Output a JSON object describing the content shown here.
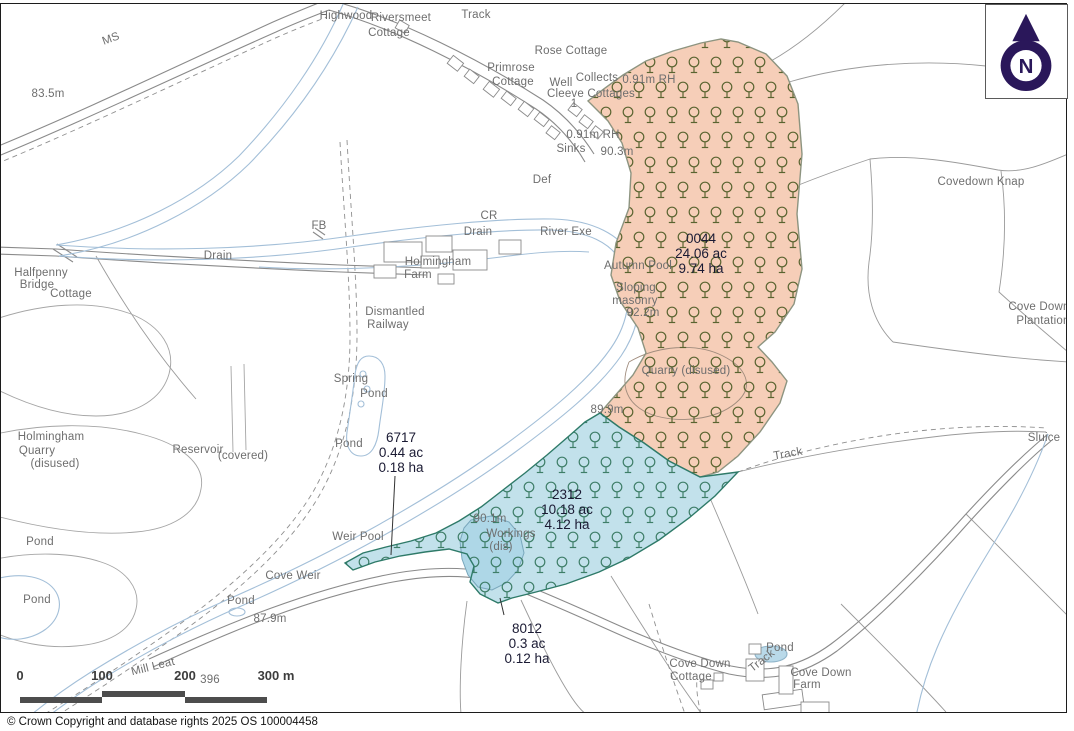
{
  "footer": {
    "copyright": "© Crown Copyright and database rights 2025 OS 100004458"
  },
  "north_arrow": {
    "label": "N"
  },
  "scale_bar": {
    "labels": [
      "0",
      "100",
      "200",
      "300 m"
    ]
  },
  "colors": {
    "parcel_orange_fill": "#f6ceb8",
    "parcel_orange_tree": "#5a6430",
    "parcel_orange_border": "#8d9480",
    "parcel_blue_fill": "#c2e1eb",
    "parcel_blue_tree": "#3e7e68",
    "parcel_blue_border": "#2e7a68",
    "parcel_label_text": "#1a1a33",
    "map_line": "#8f8f8f",
    "water_line": "#a3bfd8",
    "map_label_text": "#6e6e6e",
    "north_arrow_navy": "#2a175a",
    "scale_bar_gray": "#4d4d4d"
  },
  "map": {
    "parcels": [
      {
        "id": "0044",
        "acres": "24.06 ac",
        "hectares": "9.74 ha",
        "x": 700,
        "y": 227
      },
      {
        "id": "2312",
        "acres": "10.18 ac",
        "hectares": "4.12 ha",
        "x": 566,
        "y": 483
      },
      {
        "id": "6717",
        "acres": "0.44 ac",
        "hectares": "0.18 ha",
        "x": 400,
        "y": 426
      },
      {
        "id": "8012",
        "acres": "0.3 ac",
        "hectares": "0.12 ha",
        "x": 526,
        "y": 617
      }
    ],
    "labels": [
      {
        "text": "MS",
        "x": 110,
        "y": 35,
        "r": -20
      },
      {
        "text": "83.5m",
        "x": 47,
        "y": 90
      },
      {
        "text": "Highwood",
        "x": 345,
        "y": 12
      },
      {
        "text": "Riversmeet",
        "x": 400,
        "y": 14
      },
      {
        "text": "Cottage",
        "x": 388,
        "y": 29
      },
      {
        "text": "Track",
        "x": 475,
        "y": 11
      },
      {
        "text": "Rose Cottage",
        "x": 570,
        "y": 47
      },
      {
        "text": "Primrose",
        "x": 510,
        "y": 64
      },
      {
        "text": "Cottage",
        "x": 512,
        "y": 78
      },
      {
        "text": "Well",
        "x": 560,
        "y": 79
      },
      {
        "text": "Collects",
        "x": 596,
        "y": 74
      },
      {
        "text": "0.91m RH",
        "x": 648,
        "y": 76
      },
      {
        "text": "Cleeve Cottages",
        "x": 590,
        "y": 90
      },
      {
        "text": "1",
        "x": 573,
        "y": 100
      },
      {
        "text": "0.91m RH",
        "x": 592,
        "y": 131
      },
      {
        "text": "Sinks",
        "x": 570,
        "y": 145
      },
      {
        "text": "90.3m",
        "x": 616,
        "y": 148
      },
      {
        "text": "Def",
        "x": 541,
        "y": 176
      },
      {
        "text": "FB",
        "x": 318,
        "y": 222
      },
      {
        "text": "CR",
        "x": 488,
        "y": 212
      },
      {
        "text": "Drain",
        "x": 477,
        "y": 228
      },
      {
        "text": "River Exe",
        "x": 565,
        "y": 228
      },
      {
        "text": "Drain",
        "x": 217,
        "y": 252
      },
      {
        "text": "Halfpenny",
        "x": 40,
        "y": 269
      },
      {
        "text": "Bridge",
        "x": 36,
        "y": 281
      },
      {
        "text": "Cottage",
        "x": 70,
        "y": 290
      },
      {
        "text": "Holmingham",
        "x": 437,
        "y": 258
      },
      {
        "text": "Farm",
        "x": 417,
        "y": 271
      },
      {
        "text": "Dismantled",
        "x": 394,
        "y": 308
      },
      {
        "text": "Railway",
        "x": 387,
        "y": 321
      },
      {
        "text": "Autumn Pool",
        "x": 637,
        "y": 262
      },
      {
        "text": "Sloping",
        "x": 635,
        "y": 284
      },
      {
        "text": "masonry",
        "x": 634,
        "y": 297
      },
      {
        "text": "92.2m",
        "x": 642,
        "y": 309
      },
      {
        "text": "Quarry (disused)",
        "x": 685,
        "y": 367
      },
      {
        "text": "Covedown Knap",
        "x": 980,
        "y": 178
      },
      {
        "text": "Cove Down",
        "x": 1038,
        "y": 303
      },
      {
        "text": "Plantation",
        "x": 1042,
        "y": 317
      },
      {
        "text": "Sluice",
        "x": 1043,
        "y": 434
      },
      {
        "text": "Track",
        "x": 787,
        "y": 450,
        "r": -10
      },
      {
        "text": "Holmingham",
        "x": 50,
        "y": 433
      },
      {
        "text": "Quarry",
        "x": 36,
        "y": 447
      },
      {
        "text": "(disused)",
        "x": 54,
        "y": 460
      },
      {
        "text": "Reservoir",
        "x": 197,
        "y": 446
      },
      {
        "text": "(covered)",
        "x": 242,
        "y": 452
      },
      {
        "text": "Spring",
        "x": 350,
        "y": 375
      },
      {
        "text": "Pond",
        "x": 373,
        "y": 390
      },
      {
        "text": "Pond",
        "x": 348,
        "y": 440
      },
      {
        "text": "Pond",
        "x": 39,
        "y": 538
      },
      {
        "text": "Pond",
        "x": 36,
        "y": 596
      },
      {
        "text": "Weir Pool",
        "x": 357,
        "y": 533
      },
      {
        "text": "Cove Weir",
        "x": 292,
        "y": 572
      },
      {
        "text": "Pond",
        "x": 240,
        "y": 597
      },
      {
        "text": "87.9m",
        "x": 269,
        "y": 615
      },
      {
        "text": "89.9m",
        "x": 606,
        "y": 406
      },
      {
        "text": "90.1m",
        "x": 489,
        "y": 515
      },
      {
        "text": "Workings",
        "x": 510,
        "y": 530
      },
      {
        "text": "(dis)",
        "x": 500,
        "y": 543
      },
      {
        "text": "Mill Leat",
        "x": 152,
        "y": 663,
        "r": -14
      },
      {
        "text": "396",
        "x": 209,
        "y": 676
      },
      {
        "text": "Cove Down",
        "x": 699,
        "y": 660
      },
      {
        "text": "Cottage",
        "x": 690,
        "y": 673
      },
      {
        "text": "Pond",
        "x": 779,
        "y": 644
      },
      {
        "text": "Track",
        "x": 761,
        "y": 657,
        "r": -38
      },
      {
        "text": "Cove Down",
        "x": 820,
        "y": 669
      },
      {
        "text": "Farm",
        "x": 806,
        "y": 681
      }
    ]
  }
}
